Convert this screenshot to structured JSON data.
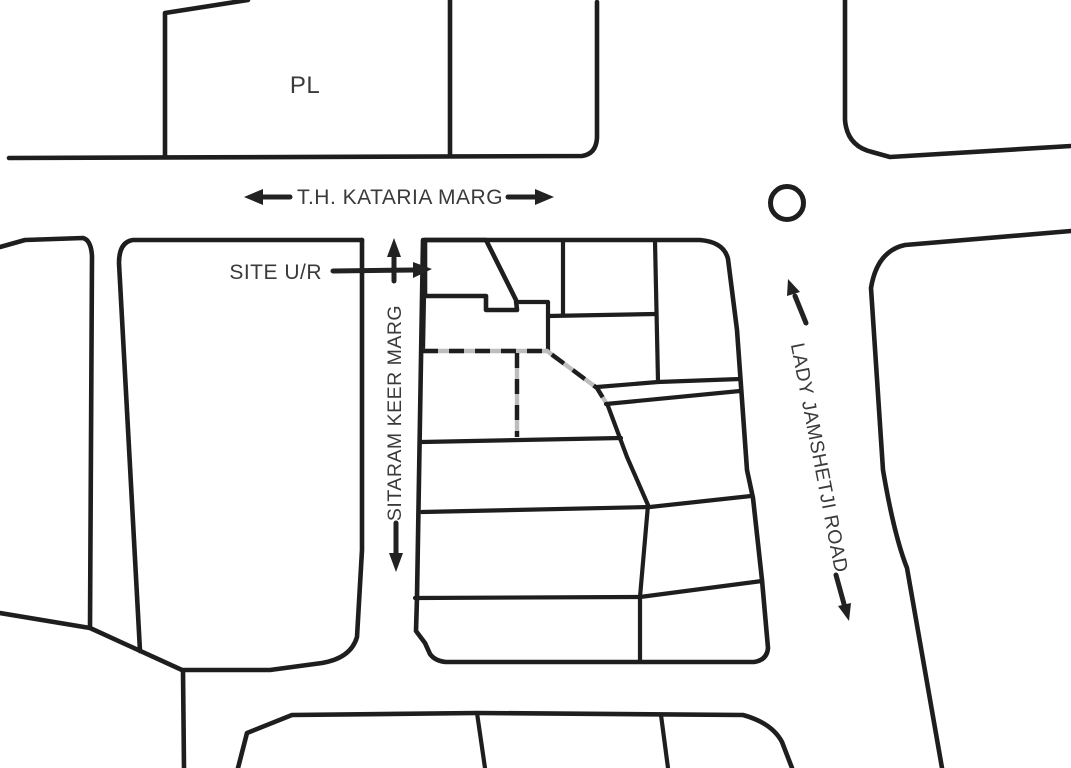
{
  "map": {
    "labels": {
      "plot_pl": "PL",
      "top_road": "T.H. KATARIA MARG",
      "site": "SITE U/R",
      "west_road": "SITARAM KEER MARG",
      "east_road": "LADY JAMSHETJI ROAD"
    },
    "colors": {
      "site_fill": "#e8352b",
      "line": "#1e1e1e",
      "text": "#3a3a3a",
      "dashed_boundary_gray": "#bdbdbd",
      "background": "#ffffff"
    },
    "icons": {
      "top_road_direction": [
        "arrow-left",
        "arrow-right"
      ],
      "west_road_direction": [
        "arrow-up",
        "arrow-down"
      ],
      "east_road_direction": [
        "arrow-up",
        "arrow-down"
      ],
      "site_pointer": "arrow-right",
      "junction_marker": "roundabout-circle"
    }
  }
}
